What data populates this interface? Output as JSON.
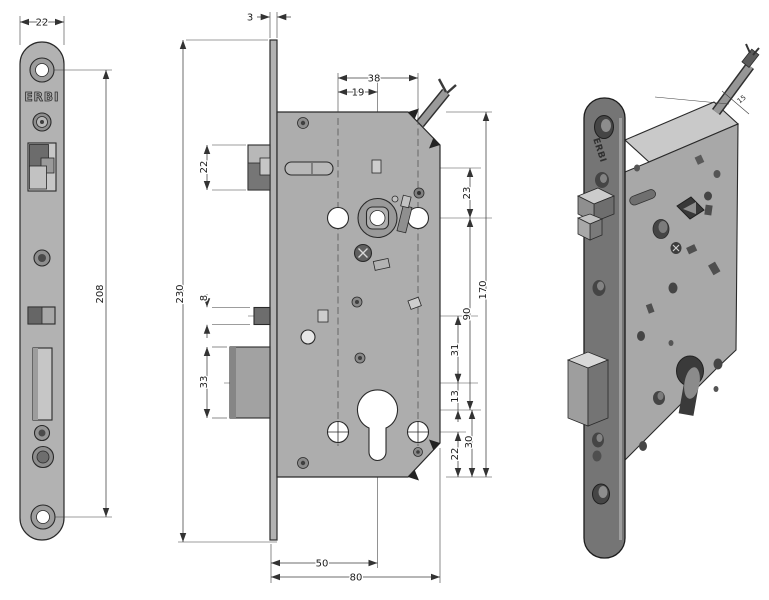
{
  "drawing": {
    "title": "mortise-lock-technical-drawing",
    "brand": "ERBI",
    "front_view": {
      "brand_label": "ERBI",
      "dims": {
        "plate_width": "22",
        "screw_hole_spacing": "208"
      }
    },
    "side_view": {
      "dims": {
        "plate_thickness": "3",
        "plate_height": "230",
        "latch_height": "22",
        "aux_bolt_height": "8",
        "deadbolt_height": "33",
        "fixing_span": "38",
        "spindle_offset": "19",
        "slot_to_spindle": "23",
        "body_height": "170",
        "spindle_to_cylinder": "90",
        "aux_to_deadbolt": "31",
        "deadbolt_to_cylinder": "13",
        "cylinder_to_bottom": "30",
        "screws_to_bottom": "22",
        "backset": "50",
        "body_depth": "80"
      }
    },
    "iso_view": {
      "brand_label": "ERBI",
      "cable_dim": "15"
    },
    "colors": {
      "plate_gray": "#b2b2b2",
      "body_gray": "#adadad",
      "dark_gray": "#6d6d6d",
      "iso_plate": "#757575",
      "iso_body": "#a8a8a8",
      "iso_top": "#c9c9c9",
      "line": "#2a2a2a",
      "hole_white": "#ffffff"
    }
  }
}
